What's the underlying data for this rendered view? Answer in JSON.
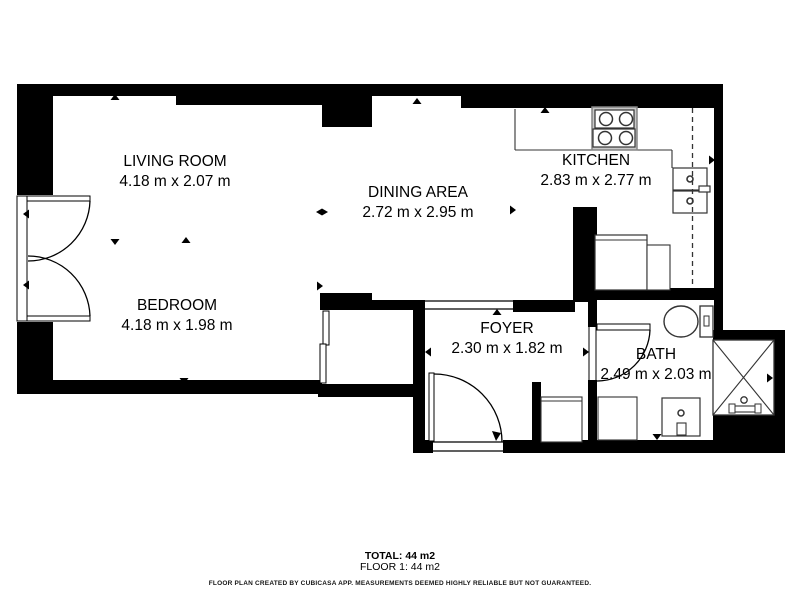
{
  "plan": {
    "title": "Floor plan - Floor 1",
    "rooms": [
      {
        "id": "living-room",
        "name": "LIVING ROOM",
        "dims": "4.18 m x 2.07 m"
      },
      {
        "id": "dining-area",
        "name": "DINING AREA",
        "dims": "2.72 m x 2.95 m"
      },
      {
        "id": "kitchen",
        "name": "KITCHEN",
        "dims": "2.83 m x 2.77 m"
      },
      {
        "id": "bedroom",
        "name": "BEDROOM",
        "dims": "4.18 m x 1.98 m"
      },
      {
        "id": "foyer",
        "name": "FOYER",
        "dims": "2.30 m x 1.82 m"
      },
      {
        "id": "bath",
        "name": "BATH",
        "dims": "2.49 m x 2.03 m"
      }
    ],
    "footer": {
      "total": "TOTAL: 44 m2",
      "floor": "FLOOR 1: 44 m2",
      "disclaimer": "FLOOR PLAN CREATED BY CUBICASA APP. MEASUREMENTS DEEMED HIGHLY RELIABLE BUT NOT GUARANTEED."
    },
    "fixtures": [
      "french-doors",
      "sliding-door",
      "entry-door",
      "bath-door",
      "window-opening",
      "stove",
      "kitchen-counter",
      "washer-stack",
      "refrigerator",
      "kitchen-cabinet",
      "toilet",
      "sink-vanity",
      "shower",
      "bath-cabinet",
      "foyer-cabinet"
    ],
    "colors": {
      "wall": "#000000",
      "fixture_stroke": "#333333",
      "stove_body": "#c9c9c9",
      "background": "#ffffff",
      "text": "#000000"
    }
  }
}
